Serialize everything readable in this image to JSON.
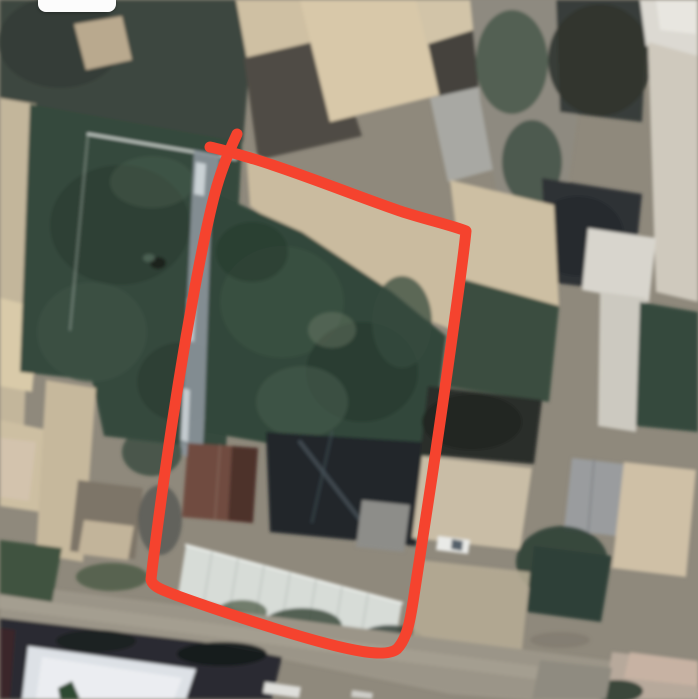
{
  "canvas": {
    "width": 698,
    "height": 699
  },
  "annotation": {
    "label": "hand-drawn property boundary",
    "color": "#F5432E",
    "stroke_width": 11,
    "path": "M 210 147 C 224 150 240 155 254 159 C 300 173 356 196 400 211 C 424 219 451 225 466 231 C 463 263 452 338 443 402 C 434 464 423 539 415 589 C 411 616 408 638 397 649 C 386 658 352 651 310 639 C 268 627 214 609 178 596 C 163 590 152 587 151 579 C 156 536 166 462 175 405 C 186 333 203 238 215 193 C 221 170 230 149 237 134"
  },
  "ui": {
    "top_pill": {
      "left": 38,
      "top": 0,
      "width": 78,
      "height": 12,
      "radius": "0 0 8px 8px",
      "color": "#fcfcfc"
    }
  },
  "scene": {
    "type": "satellite-aerial-photo",
    "base_color": "#8f897c",
    "features": [
      {
        "n": "trees-top-left",
        "t": "poly",
        "p": "0,0 255,0 243,142 90,152 0,112",
        "f": "#3e473f"
      },
      {
        "n": "trees-top-left-dark",
        "t": "ell",
        "p": [
          60,
          42,
          62,
          46
        ],
        "f": "#343d36",
        "o": 0.9
      },
      {
        "n": "tan-roof-top-left",
        "t": "poly",
        "p": "74,24 122,16 132,60 86,70",
        "f": "#b9a98e"
      },
      {
        "n": "left-wall-strip",
        "t": "poly",
        "p": "0,98 36,104 22,482 0,477",
        "f": "#c3b69b"
      },
      {
        "n": "left-beige-patch-1",
        "t": "poly",
        "p": "0,298 40,308 32,392 0,386",
        "f": "#d9caa9"
      },
      {
        "n": "left-beige-patch-2",
        "t": "poly",
        "p": "0,420 48,430 40,512 0,506",
        "f": "#cdbfa2"
      },
      {
        "n": "garden-left",
        "t": "poly",
        "p": "30,104 242,142 226,450 104,436 92,380 20,372",
        "f": "#35493d"
      },
      {
        "n": "garden-left-blob-1",
        "t": "ell",
        "p": [
          120,
          225,
          70,
          60
        ],
        "f": "#2c3e33",
        "o": 0.85
      },
      {
        "n": "garden-left-blob-2",
        "t": "ell",
        "p": [
          92,
          332,
          55,
          50
        ],
        "f": "#3d5345",
        "o": 0.7
      },
      {
        "n": "garden-left-blob-3",
        "t": "ell",
        "p": [
          182,
          382,
          45,
          40
        ],
        "f": "#2c3e33",
        "o": 0.65
      },
      {
        "n": "garden-left-blob-4",
        "t": "ell",
        "p": [
          152,
          182,
          42,
          26
        ],
        "f": "#42584a",
        "o": 0.6
      },
      {
        "n": "garden-white-edge",
        "t": "path",
        "p": "M 88 134 L 236 159",
        "s": "#d9dfd9",
        "w": 2.5,
        "o": 0.9
      },
      {
        "n": "garden-white-edge-left",
        "t": "path",
        "p": "M 88 134 L 70 330",
        "s": "#cfd6cf",
        "w": 1.5,
        "o": 0.45
      },
      {
        "n": "garden-dark-hole",
        "t": "ell",
        "p": [
          158,
          263,
          8,
          6
        ],
        "f": "#1a241f"
      },
      {
        "n": "garden-hole-rim",
        "t": "ell",
        "p": [
          149,
          258,
          6,
          4
        ],
        "f": "#5a6f60",
        "o": 0.7
      },
      {
        "n": "light-track",
        "t": "poly",
        "p": "194,150 220,155 202,462 180,454",
        "f": "#8c959b",
        "o": 0.9
      },
      {
        "n": "track-dash-1",
        "t": "poly",
        "p": "196,162 206,164 204,196 194,194",
        "f": "#d2d9dd",
        "o": 0.9
      },
      {
        "n": "track-dash-2",
        "t": "poly",
        "p": "188,298 196,300 194,342 186,340",
        "f": "#cbd3d9",
        "o": 0.8
      },
      {
        "n": "track-dash-3",
        "t": "poly",
        "p": "183,388 190,390 188,442 181,440",
        "f": "#d4dbdf",
        "o": 0.8
      },
      {
        "n": "roof-top-a",
        "t": "poly",
        "p": "236,0 312,0 332,56 250,76",
        "f": "#cfc0a3"
      },
      {
        "n": "shadow-patch-top",
        "t": "poly",
        "p": "244,58 330,38 362,136 258,160",
        "f": "#504c45"
      },
      {
        "n": "big-tan-roof-top",
        "t": "poly",
        "p": "300,0 428,0 452,92 330,122",
        "f": "#d8c8a9"
      },
      {
        "n": "beige-roof-top-b",
        "t": "poly",
        "p": "416,0 472,0 480,36 428,50",
        "f": "#d2c4a8"
      },
      {
        "n": "dark-band-top",
        "t": "poly",
        "p": "428,44 480,28 497,110 446,126",
        "f": "#45433d"
      },
      {
        "n": "gray-roof-top",
        "t": "poly",
        "p": "430,98 492,84 507,166 448,182",
        "f": "#a8a8a3"
      },
      {
        "n": "courtyard-band-center",
        "t": "poly",
        "p": "470,0 562,0 577,120 560,242 504,232 480,100",
        "f": "#8e8a80"
      },
      {
        "n": "courtyard-trees-1",
        "t": "ell",
        "p": [
          512,
          62,
          36,
          52
        ],
        "f": "#49584a",
        "o": 0.85
      },
      {
        "n": "courtyard-trees-2",
        "t": "ell",
        "p": [
          532,
          162,
          30,
          42
        ],
        "f": "#3f4e42",
        "o": 0.8
      },
      {
        "n": "dark-trees-top-right",
        "t": "poly",
        "p": "556,0 648,0 642,122 560,112",
        "f": "#393e3a"
      },
      {
        "n": "dark-trees-top-right-blob",
        "t": "ell",
        "p": [
          600,
          60,
          52,
          56
        ],
        "f": "#30352f",
        "o": 0.9
      },
      {
        "n": "white-roof-top-right",
        "t": "poly",
        "p": "640,0 698,0 698,56 646,46",
        "f": "#dcd9d2"
      },
      {
        "n": "white-roof-top-right-bright",
        "t": "poly",
        "p": "656,0 696,0 696,34 660,30",
        "f": "#e9e7e1",
        "o": 0.9
      },
      {
        "n": "right-edge-band",
        "t": "poly",
        "p": "648,42 698,56 698,302 656,292",
        "f": "#cfc9bd"
      },
      {
        "n": "dark-trees-mid-right",
        "t": "poly",
        "p": "542,178 642,194 632,292 546,282",
        "f": "#2e3335"
      },
      {
        "n": "dark-trees-mid-right-blob",
        "t": "ell",
        "p": [
          578,
          236,
          46,
          40
        ],
        "f": "#262b2e",
        "o": 0.9
      },
      {
        "n": "beige-court-right",
        "t": "poly",
        "p": "450,180 554,205 559,306 462,279",
        "f": "#cdbfa3"
      },
      {
        "n": "green-right-of-plot",
        "t": "poly",
        "p": "462,279 559,306 549,402 448,387",
        "f": "#3a4e41"
      },
      {
        "n": "white-roof-right",
        "t": "poly",
        "p": "588,228 656,238 649,302 582,290",
        "f": "#d8d5cd"
      },
      {
        "n": "white-band-right",
        "t": "poly",
        "p": "600,292 646,298 636,432 598,426",
        "f": "#ccc9c0"
      },
      {
        "n": "dark-green-right",
        "t": "poly",
        "p": "640,302 698,312 698,432 636,426",
        "f": "#35493c"
      },
      {
        "n": "plot-courtyard-top",
        "t": "poly",
        "p": "246,152 467,232 452,330 380,300 300,242 250,206",
        "f": "#cabb9f"
      },
      {
        "n": "plot-garden",
        "t": "poly",
        "p": "212,192 302,232 392,292 446,336 428,482 392,472 262,442 204,432",
        "f": "#31463a"
      },
      {
        "n": "plot-garden-blob-1",
        "t": "ell",
        "p": [
          282,
          302,
          62,
          56
        ],
        "f": "#3c5243",
        "o": 0.8
      },
      {
        "n": "plot-garden-blob-2",
        "t": "ell",
        "p": [
          362,
          372,
          56,
          50
        ],
        "f": "#283a30",
        "o": 0.8
      },
      {
        "n": "plot-garden-blob-3",
        "t": "ell",
        "p": [
          302,
          402,
          46,
          36
        ],
        "f": "#42584a",
        "o": 0.7
      },
      {
        "n": "plot-garden-blob-4",
        "t": "ell",
        "p": [
          252,
          252,
          36,
          30
        ],
        "f": "#2a3c31",
        "o": 0.7
      },
      {
        "n": "plot-garden-blob-5",
        "t": "ell",
        "p": [
          402,
          322,
          30,
          46
        ],
        "f": "#354b3d",
        "o": 0.75
      },
      {
        "n": "plot-garden-light-patch",
        "t": "ell",
        "p": [
          332,
          330,
          24,
          18
        ],
        "f": "#76816f",
        "o": 0.4
      },
      {
        "n": "plot-shadow-block",
        "t": "poly",
        "p": "266,432 422,442 416,546 270,532",
        "f": "#20262a"
      },
      {
        "n": "branch-streak-1",
        "t": "path",
        "p": "M 300 442 L 362 522",
        "s": "#5d6a74",
        "w": 4,
        "o": 0.5
      },
      {
        "n": "branch-streak-2",
        "t": "path",
        "p": "M 332 432 L 312 522",
        "s": "#4a565e",
        "w": 3,
        "o": 0.45
      },
      {
        "n": "brown-roof-building",
        "t": "poly",
        "p": "188,443 258,448 252,523 182,517",
        "f": "#6f4b40"
      },
      {
        "n": "brown-roof-dark-half",
        "t": "poly",
        "p": "232,446 258,448 253,523 228,520",
        "f": "#4d332c"
      },
      {
        "n": "brown-roof-ridge",
        "t": "path",
        "p": "M 220 445 L 215 520",
        "s": "#8a6a5c",
        "w": 1.5,
        "o": 0.8
      },
      {
        "n": "gray-roof-in-plot",
        "t": "poly",
        "p": "362,500 410,505 404,552 356,547",
        "f": "#8d8d89"
      },
      {
        "n": "corrugated-roof",
        "t": "poly",
        "p": "186,545 402,603 394,650 178,595",
        "f": "#d7dcd7"
      },
      {
        "n": "corrugated-roof-edge",
        "t": "path",
        "p": "M 186 545 L 402 603",
        "s": "#eef2ee",
        "w": 2.5,
        "o": 0.9
      },
      {
        "n": "corrugated-roof-ribs",
        "t": "path",
        "p": "M 212 552 l -8 49 M 238 559 l -8 49 M 264 566 l -8 49 M 290 573 l -8 49 M 316 580 l -8 49 M 342 587 l -8 49 M 368 594 l -8 49",
        "s": "#b9c1bb",
        "w": 1.5,
        "o": 0.8
      },
      {
        "n": "bushes-1",
        "t": "ell",
        "p": [
          302,
          626,
          40,
          18
        ],
        "f": "#3c4a3c",
        "o": 0.85
      },
      {
        "n": "bushes-2",
        "t": "ell",
        "p": [
          390,
          641,
          34,
          16
        ],
        "f": "#35423a",
        "o": 0.85
      },
      {
        "n": "bushes-3",
        "t": "ell",
        "p": [
          242,
          612,
          25,
          12
        ],
        "f": "#46543f",
        "o": 0.7
      },
      {
        "n": "dark-tree-band-lower-right",
        "t": "poly",
        "p": "428,386 542,400 534,464 420,454",
        "f": "#2b2e2b"
      },
      {
        "n": "dark-tree-band-blob",
        "t": "ell",
        "p": [
          472,
          422,
          50,
          28
        ],
        "f": "#232621",
        "o": 0.9
      },
      {
        "n": "tan-courtyard-lower-right",
        "t": "poly",
        "p": "422,456 532,468 520,550 412,538",
        "f": "#c9bda6"
      },
      {
        "n": "white-car",
        "t": "poly",
        "p": "438,536 470,540 468,554 436,550",
        "f": "#e9eae7"
      },
      {
        "n": "white-car-windshield",
        "t": "poly",
        "p": "452,539 463,541 462,551 451,549",
        "f": "#55606a"
      },
      {
        "n": "gray-roof-lower-right",
        "t": "poly",
        "p": "572,458 624,464 616,536 564,530",
        "f": "#9a9c9e"
      },
      {
        "n": "gray-roof-ridge",
        "t": "path",
        "p": "M 594 460 L 588 534",
        "s": "#7d8184",
        "w": 2,
        "o": 0.7
      },
      {
        "n": "beige-roof-bottom-right",
        "t": "poly",
        "p": "624,462 696,470 686,577 612,568",
        "f": "#cfc0a6"
      },
      {
        "n": "green-tree-bottom-right",
        "t": "ell",
        "p": [
          562,
          562,
          46,
          36
        ],
        "f": "#33443a",
        "o": 0.95
      },
      {
        "n": "green-patch-bottom-right",
        "t": "poly",
        "p": "534,546 612,556 601,622 527,612",
        "f": "#2f4037"
      },
      {
        "n": "vertical-building-left",
        "t": "poly",
        "p": "46,380 96,388 83,562 36,554",
        "f": "#c6b89c"
      },
      {
        "n": "brown-roof-left",
        "t": "poly",
        "p": "78,480 143,488 135,559 70,551",
        "f": "#7d7468"
      },
      {
        "n": "tan-roof-left",
        "t": "poly",
        "p": "84,520 134,526 128,560 78,554",
        "f": "#c2b49a"
      },
      {
        "n": "pink-tan-left",
        "t": "poly",
        "p": "0,438 36,442 29,501 0,497",
        "f": "#d3c3ad"
      },
      {
        "n": "small-green-left",
        "t": "ell",
        "p": [
          152,
          452,
          30,
          24
        ],
        "f": "#374b3e",
        "o": 0.8
      },
      {
        "n": "shadow-left-of-plot",
        "t": "ell",
        "p": [
          160,
          520,
          22,
          35
        ],
        "f": "#4e524e",
        "o": 0.7
      },
      {
        "n": "light-courtyard-wedge",
        "t": "poly",
        "p": "420,560 530,572 522,650 412,638",
        "f": "#b5ab94",
        "o": 0.9
      },
      {
        "n": "road",
        "t": "poly",
        "p": "0,583 262,615 450,640 698,672 698,714 450,694 262,655 0,622",
        "f": "#9b9588"
      },
      {
        "n": "road-light-stripe",
        "t": "path",
        "p": "M 0 602 C 200 628 450 662 698 694",
        "s": "#a9a395",
        "w": 13,
        "o": 0.65
      },
      {
        "n": "road-dark-mark",
        "t": "ell",
        "p": [
          560,
          640,
          30,
          8
        ],
        "f": "#7a7468",
        "o": 0.5
      },
      {
        "n": "green-strip-left-of-road",
        "t": "poly",
        "p": "0,540 62,548 52,602 0,594",
        "f": "#41523f"
      },
      {
        "n": "green-strip-blob",
        "t": "ell",
        "p": [
          112,
          577,
          36,
          14
        ],
        "f": "#4a5a44",
        "o": 0.8
      },
      {
        "n": "bottom-left-structure",
        "t": "poly",
        "p": "0,618 202,642 282,657 272,699 0,699",
        "f": "#2a2b31"
      },
      {
        "n": "white-roof-bottom-left",
        "t": "poly",
        "p": "28,646 196,669 186,699 22,699",
        "f": "#dde1e6"
      },
      {
        "n": "white-roof-bottom-left-inner",
        "t": "poly",
        "p": "42,657 182,678 174,699 36,699",
        "f": "#eceef2",
        "o": 0.9
      },
      {
        "n": "dark-tree-bottom-left-1",
        "t": "ell",
        "p": [
          96,
          641,
          40,
          11
        ],
        "f": "#1d2020",
        "o": 0.95
      },
      {
        "n": "dark-tree-bottom-left-2",
        "t": "ell",
        "p": [
          222,
          654,
          45,
          12
        ],
        "f": "#17191b",
        "o": 0.95
      },
      {
        "n": "maroon-strip-bottom-left",
        "t": "poly",
        "p": "0,628 15,630 10,699 0,699",
        "f": "#3a2629"
      },
      {
        "n": "green-sprig-bottom-left",
        "t": "poly",
        "p": "58,688 72,681 80,699 60,699",
        "f": "#2f4a33"
      },
      {
        "n": "car-on-road-1",
        "t": "poly",
        "p": "265,682 301,687 299,698 263,693",
        "f": "#dfdfdb"
      },
      {
        "n": "car-on-road-2",
        "t": "poly",
        "p": "352,690 373,693 372,699 351,697",
        "f": "#d5d5d0",
        "o": 0.9
      },
      {
        "n": "bottom-right-roofs",
        "t": "poly",
        "p": "612,652 698,662 698,699 604,699",
        "f": "#b7a99b"
      },
      {
        "n": "bottom-right-pink-roof",
        "t": "poly",
        "p": "630,652 698,661 698,686 624,678",
        "f": "#c9b2a4",
        "o": 0.9
      },
      {
        "n": "bottom-right-green-patch",
        "t": "ell",
        "p": [
          581,
          686,
          22,
          13
        ],
        "f": "#3b5040"
      },
      {
        "n": "bottom-right-dark-veg",
        "t": "ell",
        "p": [
          617,
          691,
          26,
          11
        ],
        "f": "#2e3b31",
        "o": 0.9
      },
      {
        "n": "bottom-right-gray",
        "t": "poly",
        "p": "540,660 612,668 606,699 532,699",
        "f": "#8f8b80"
      }
    ]
  }
}
